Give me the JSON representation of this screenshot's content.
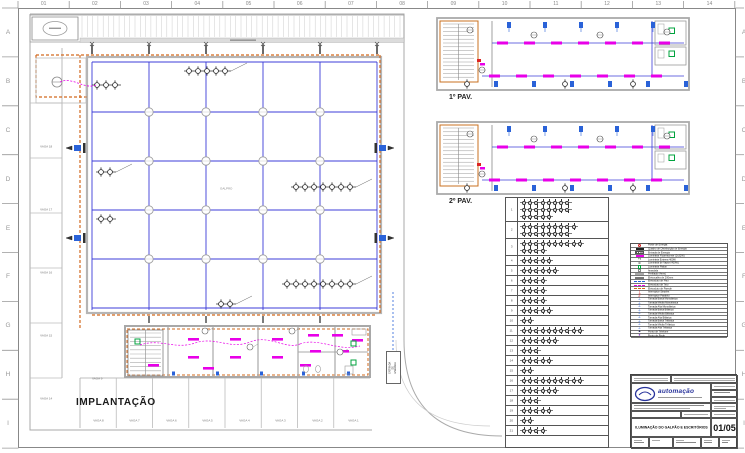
{
  "sheet": {
    "top_labels": [
      "01",
      "02",
      "03",
      "04",
      "05",
      "06",
      "07",
      "08",
      "09",
      "10",
      "11",
      "12",
      "13",
      "14"
    ],
    "side_labels": [
      "A",
      "B",
      "C",
      "D",
      "E",
      "F",
      "G",
      "H",
      "I"
    ]
  },
  "implantacao": {
    "title": "IMPLANTAÇÃO",
    "hall_label": "GALPÃO",
    "entry_label": "ENTRADA DE ENERGIA",
    "vaga_inner": "VAGA 9",
    "vagas_bottom": [
      "VAGA 8",
      "VAGA 7",
      "VAGA 6",
      "VAGA 5",
      "VAGA 4",
      "VAGA 3",
      "VAGA 2",
      "VAGA 1"
    ],
    "vagas_left": [
      "VAGA 18",
      "VAGA 17",
      "VAGA 16",
      "VAGA 15",
      "VAGA 14"
    ]
  },
  "pavements": {
    "pav1": "1º PAV.",
    "pav2": "2º PAV."
  },
  "circuit_table": {
    "rows": [
      {
        "lamps": [
          8,
          8,
          5
        ]
      },
      {
        "lamps": [
          9,
          8
        ]
      },
      {
        "lamps": [
          10,
          4
        ]
      },
      {
        "lamps": [
          5
        ]
      },
      {
        "lamps": [
          6
        ]
      },
      {
        "lamps": [
          4
        ]
      },
      {
        "lamps": [
          4
        ]
      },
      {
        "lamps": [
          4
        ]
      },
      {
        "lamps": [
          5
        ]
      },
      {
        "lamps": [
          2
        ]
      },
      {
        "lamps": [
          10
        ]
      },
      {
        "lamps": [
          6
        ]
      },
      {
        "lamps": [
          3
        ]
      },
      {
        "lamps": [
          5
        ]
      },
      {
        "lamps": [
          2
        ]
      },
      {
        "lamps": [
          10
        ]
      },
      {
        "lamps": [
          6
        ]
      },
      {
        "lamps": [
          3
        ]
      },
      {
        "lamps": [
          5
        ]
      },
      {
        "lamps": [
          2
        ]
      },
      {
        "lamps": [
          4
        ]
      }
    ]
  },
  "legend": {
    "rows": [
      {
        "label": "Poste de Energia",
        "kind": "circle",
        "color": "#cc2222"
      },
      {
        "label": "Quadro de Distribuição de Energia",
        "kind": "rect",
        "color": "#222222"
      },
      {
        "label": "Entrada de Energia",
        "kind": "hatch",
        "color": "#555555"
      },
      {
        "label": "Luminária Fluorescente (2x32W)",
        "kind": "rect",
        "color": "#e800e8"
      },
      {
        "label": "Luminária Externa 400W",
        "kind": "char",
        "char": "+▪",
        "color": "#222222"
      },
      {
        "label": "Luminária de Vapor (400W)",
        "kind": "char",
        "char": "⊗",
        "color": "#555555"
      },
      {
        "label": "Luminária Plafon",
        "kind": "square",
        "color": "#00a33e"
      },
      {
        "label": "Arandela",
        "kind": "square",
        "color": "#888888"
      },
      {
        "label": "Perfilado (4mm)",
        "kind": "bar",
        "color": "#aaaaaa"
      },
      {
        "label": "Eletrocalha de 200mm",
        "kind": "bar",
        "color": "#777777"
      },
      {
        "label": "Eletroduto de Piso",
        "kind": "dash",
        "color": "#2a62d8"
      },
      {
        "label": "Eletroduto de Teto",
        "kind": "dash",
        "color": "#e800e8"
      },
      {
        "label": "Eletroduto de Parede",
        "kind": "dash",
        "color": "#d2691e"
      },
      {
        "label": "Interruptor Simples",
        "kind": "char",
        "char": "∫",
        "color": "#cc2222"
      },
      {
        "label": "Interruptor Paralelo",
        "kind": "char",
        "char": "∬",
        "color": "#cc2222"
      },
      {
        "label": "Tomada Baixa Monofásica",
        "kind": "char",
        "char": "⊥",
        "color": "#2a62d8"
      },
      {
        "label": "Tomada Média Monofásica",
        "kind": "char",
        "char": "⊥",
        "color": "#2a62d8"
      },
      {
        "label": "Tomada Alta Monofásica",
        "kind": "char",
        "char": "⊥",
        "color": "#2a62d8"
      },
      {
        "label": "Tomada Baixa Bifásica",
        "kind": "char",
        "char": "⊥",
        "color": "#2a62d8"
      },
      {
        "label": "Tomada Média Bifásica",
        "kind": "char",
        "char": "⊥",
        "color": "#2a62d8"
      },
      {
        "label": "Tomada Alta Bifásica",
        "kind": "char",
        "char": "⊥",
        "color": "#2a62d8"
      },
      {
        "label": "Tomada Baixa Trifásica",
        "kind": "char",
        "char": "⊥",
        "color": "#2a62d8"
      },
      {
        "label": "Tomada Média Trifásica",
        "kind": "char",
        "char": "⊥",
        "color": "#2a62d8"
      },
      {
        "label": "Tomada Alta Trifásica",
        "kind": "char",
        "char": "⊥",
        "color": "#2a62d8"
      },
      {
        "label": "Ponto de Telefone",
        "kind": "char",
        "char": "▲",
        "color": "#333366"
      },
      {
        "label": "Ponto de Rede",
        "kind": "char",
        "char": "●",
        "color": "#7b2fbe"
      }
    ]
  },
  "titleblock": {
    "logo_text": "automação",
    "project_type": "PROJETO ELÉTRICO",
    "sheet_title": "ILUMINAÇÃO DO GALPÃO E ESCRITÓRIOS",
    "sheet_number": "01/05",
    "date": "11.JUL.2012"
  }
}
